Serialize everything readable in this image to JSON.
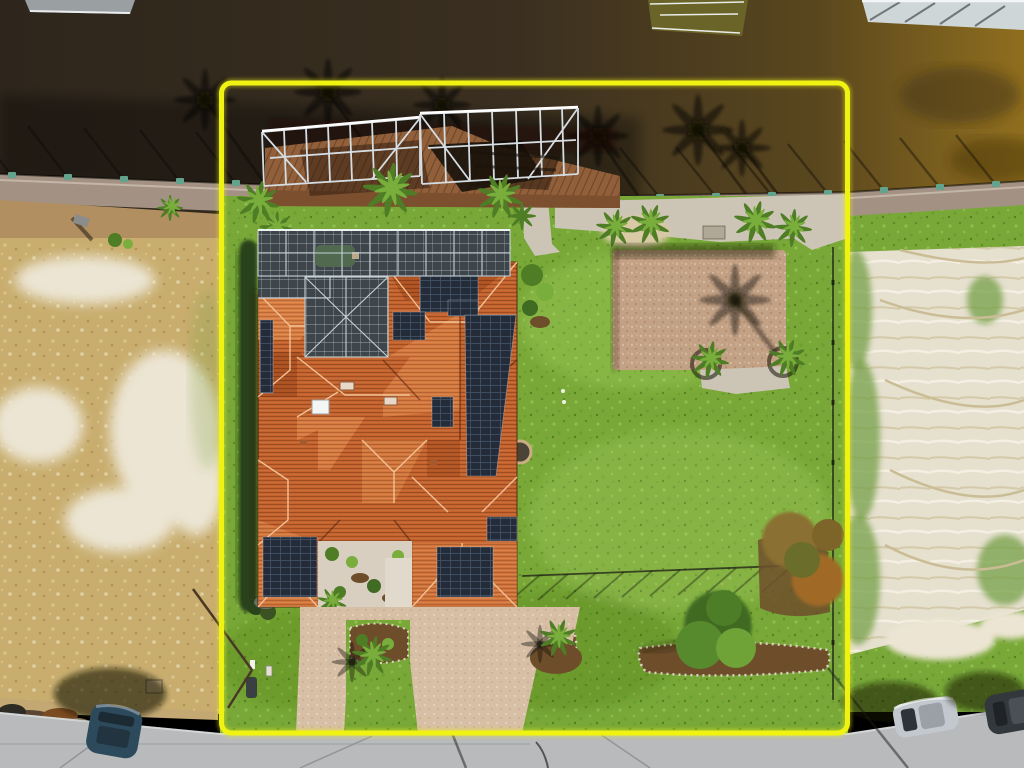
{
  "meta": {
    "type": "aerial-drone-photograph",
    "description": "Overhead aerial view of a large waterfront home with terracotta tile roof, rooftop solar arrays and screened pool enclosure, outlined by a bright yellow property-boundary rectangle. A dark canal with a wooden dock and two aluminum boat-lift frames runs along the top, vacant sandy lots flank the property, palm trees dot the lawn, a paver patio and driveway lead to a gray street at the bottom where three cars are parked."
  },
  "annotations": {
    "boundary": {
      "shape": "rectangle",
      "color": "#f0f312"
    },
    "parked_cars": 3,
    "boat_lifts": 2,
    "features": [
      "canal water",
      "far-shore docks",
      "seawall with pilings",
      "wooden dock",
      "aluminum boat lifts",
      "palm tree shadows on water",
      "screened pool enclosure",
      "terracotta hip roof",
      "solar panel arrays",
      "skylights",
      "paver patio",
      "backyard lawn",
      "perimeter fence",
      "garden beds",
      "hedge row",
      "paver driveway and walkway",
      "courtyard",
      "vacant dry lot (left)",
      "vacant sandy lot (right)",
      "street",
      "parked cars",
      "debris pile"
    ]
  },
  "palette": {
    "water1": "#2e261c",
    "water2": "#3a2f20",
    "water3": "#5a471e",
    "water4": "#8f6e1e",
    "seawall": "#a39283",
    "dirt": "#b28f60",
    "dock-wood": "#91603a",
    "dock-wood2": "#7c4f2e",
    "lift": "#d5dde2",
    "lift-hi": "#ffffff",
    "screen": "#3f464b",
    "screen-frame": "#c6d2d8",
    "pool": "#50694f",
    "roof": "#c3622d",
    "roof-light": "#d97e42",
    "roof-dark": "#a84e20",
    "ridge": "#f2c092",
    "solar": "#232c38",
    "solar-line": "#44546a",
    "lawn": "#79a838",
    "hedge": "#2b431b",
    "palm-dark": "#4e7d26",
    "palm-light": "#79ae3c",
    "mulch": "#6e4d2b",
    "stone": "#ddd6c4",
    "dry": "#c8ad6e",
    "sand": "#e9e3d2",
    "sand-lot": "#e6e0cf",
    "road": "#b8babb",
    "paver": "#c3a184",
    "paver-drive": "#d6bfa4",
    "concrete": "#ccc5b6",
    "boundary": "#f0f312",
    "car-blue": "#2d4a5c",
    "car-silver": "#c2c8cd",
    "car-dark": "#33383d",
    "piling": "#63a38e"
  }
}
